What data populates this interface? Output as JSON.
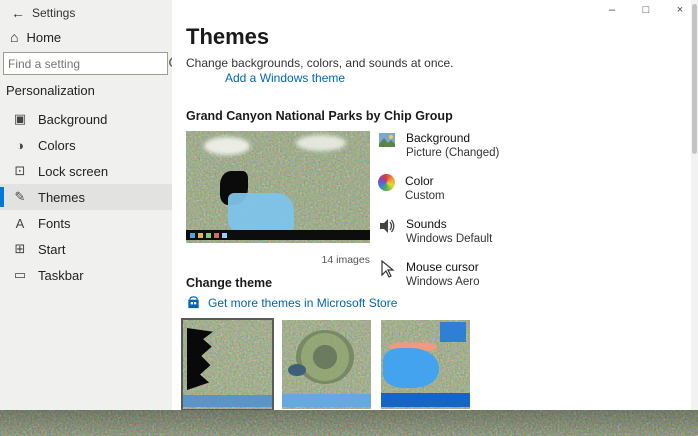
{
  "window": {
    "title": "Settings",
    "caption_buttons": {
      "minimize": "–",
      "maximize": "□",
      "close": "×"
    }
  },
  "sidebar": {
    "back": "←",
    "home_icon": "⌂",
    "home": "Home",
    "search_placeholder": "Find a setting",
    "section": "Personalization",
    "items": [
      {
        "label": "Background",
        "icon": "▣"
      },
      {
        "label": "Colors",
        "icon": "◑"
      },
      {
        "label": "Lock screen",
        "icon": "⊡"
      },
      {
        "label": "Themes",
        "icon": "✎",
        "selected": true
      },
      {
        "label": "Fonts",
        "icon": "A"
      },
      {
        "label": "Start",
        "icon": "⊞"
      },
      {
        "label": "Taskbar",
        "icon": "▭"
      }
    ]
  },
  "main": {
    "title": "Themes",
    "intro": "Change backgrounds, colors, and sounds at once.",
    "add_link": "Add a Windows theme",
    "current_theme": "Grand Canyon National Parks by Chip Group",
    "preview_caption": "14 images",
    "theme_parts": [
      {
        "label": "Background",
        "value": "Picture (Changed)",
        "icon": "picture-icon"
      },
      {
        "label": "Color",
        "value": "Custom",
        "icon": "color-wheel-icon"
      },
      {
        "label": "Sounds",
        "value": "Windows Default",
        "icon": "speaker-icon"
      },
      {
        "label": "Mouse cursor",
        "value": "Windows Aero",
        "icon": "cursor-icon"
      }
    ],
    "change_theme_heading": "Change theme",
    "store_link": "Get more themes in Microsoft Store"
  },
  "aside": {
    "promo_heading": "Personalize your PC",
    "promo_text": "Make your desktop feel more personal with themes that combine wallpapers, colors, and sounds.",
    "related_heading": "Related Settings",
    "links": [
      "Desktop icon settings",
      "High contrast settings",
      "Sync your settings"
    ],
    "help": "Get help",
    "feedback": "Give feedback"
  },
  "colors": {
    "accent": "#0078d7",
    "link": "#0066b4",
    "sidebar_bg": "#f0f0ef"
  }
}
